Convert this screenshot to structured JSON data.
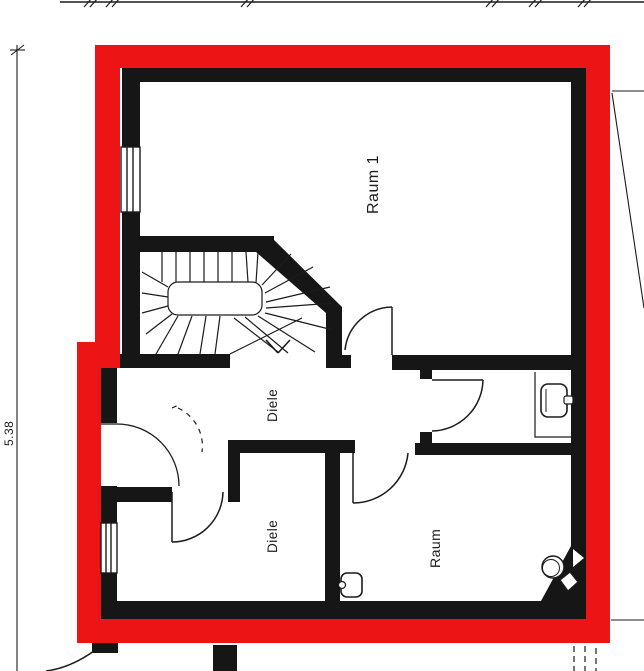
{
  "colors": {
    "outline_red": "#ec1414",
    "wall_black": "#161616",
    "line_black": "#1c1c1c"
  },
  "rooms": {
    "room1_label": "Raum 1",
    "hall_upper_label": "Diele",
    "hall_lower_label": "Diele",
    "room2_label": "Raum"
  },
  "dimensions": {
    "left_height": "5.38"
  }
}
